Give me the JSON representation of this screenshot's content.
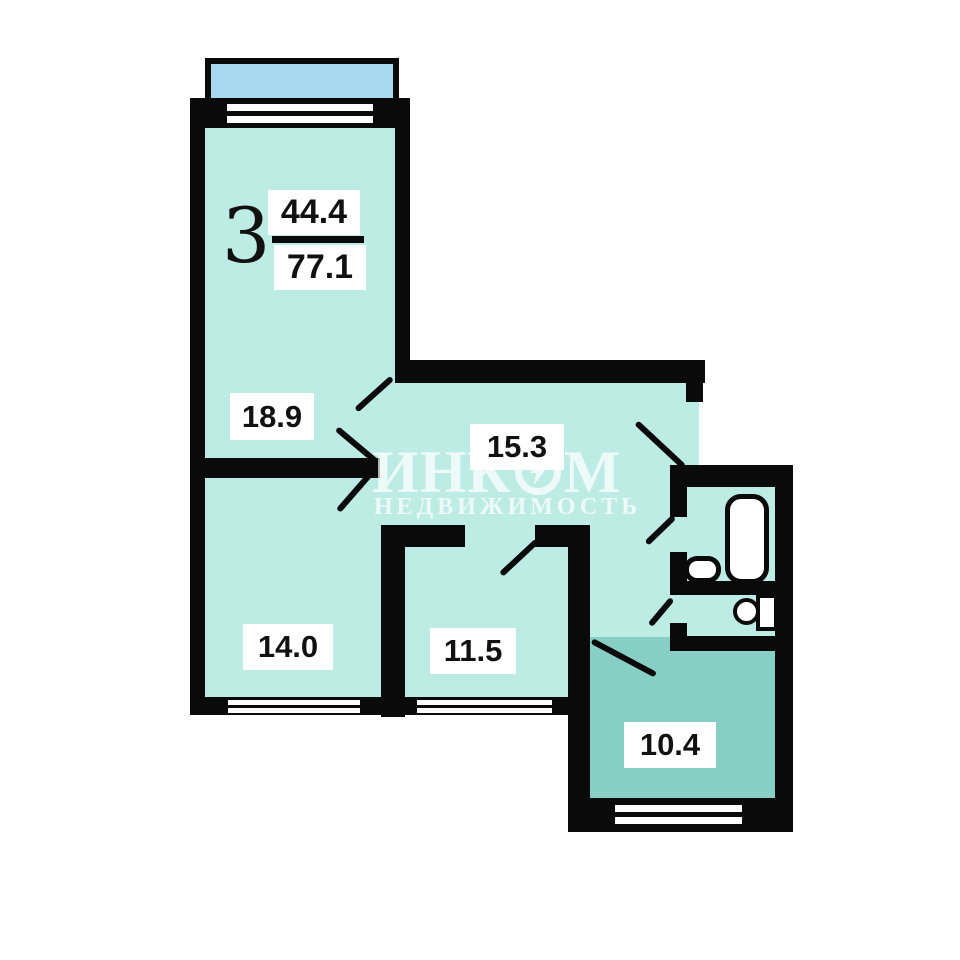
{
  "floor_plan": {
    "unit_rooms_count": "3",
    "area_fraction": {
      "living": "44.4",
      "total": "77.1"
    },
    "rooms": {
      "bedroom_large": "18.9",
      "hallway": "15.3",
      "bedroom_left": "14.0",
      "bedroom_middle": "11.5",
      "kitchen": "10.4"
    },
    "watermark": {
      "brand_start": "ИНК",
      "brand_end": "М",
      "subtitle": "НЕДВИЖИМОСТЬ"
    },
    "colors": {
      "room_fill": "#bdece4",
      "kitchen_fill": "#87cfc5",
      "balcony_fill": "#a7d8ee",
      "wall": "#0a0a0a",
      "label_bg": "#ffffff",
      "watermark": "rgba(255,255,255,0.72)"
    }
  }
}
